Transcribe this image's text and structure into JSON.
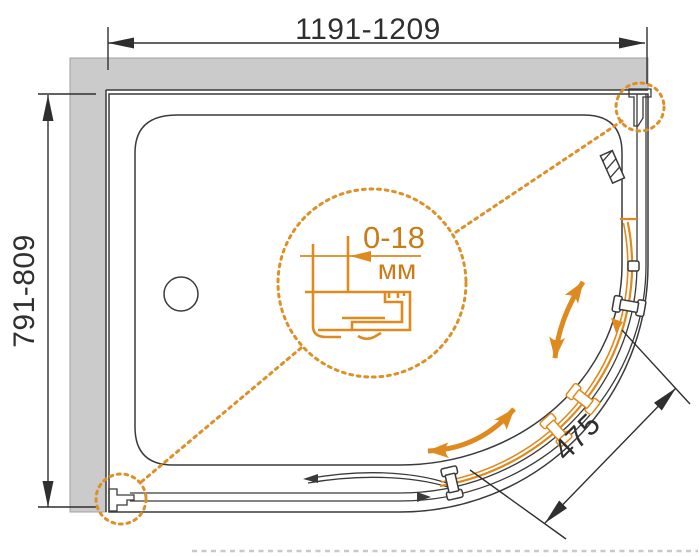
{
  "labels": {
    "width_range": "1191-1209",
    "depth_range": "791-809",
    "entry_width": "475",
    "adjustment_range": "0-18",
    "adjustment_unit": "мм"
  },
  "colors": {
    "accent_orange": "#DE8A1E",
    "accent_text": "#C97C18",
    "wall_gray": "#CBCBCB",
    "line_dark": "#3A3A3A"
  }
}
